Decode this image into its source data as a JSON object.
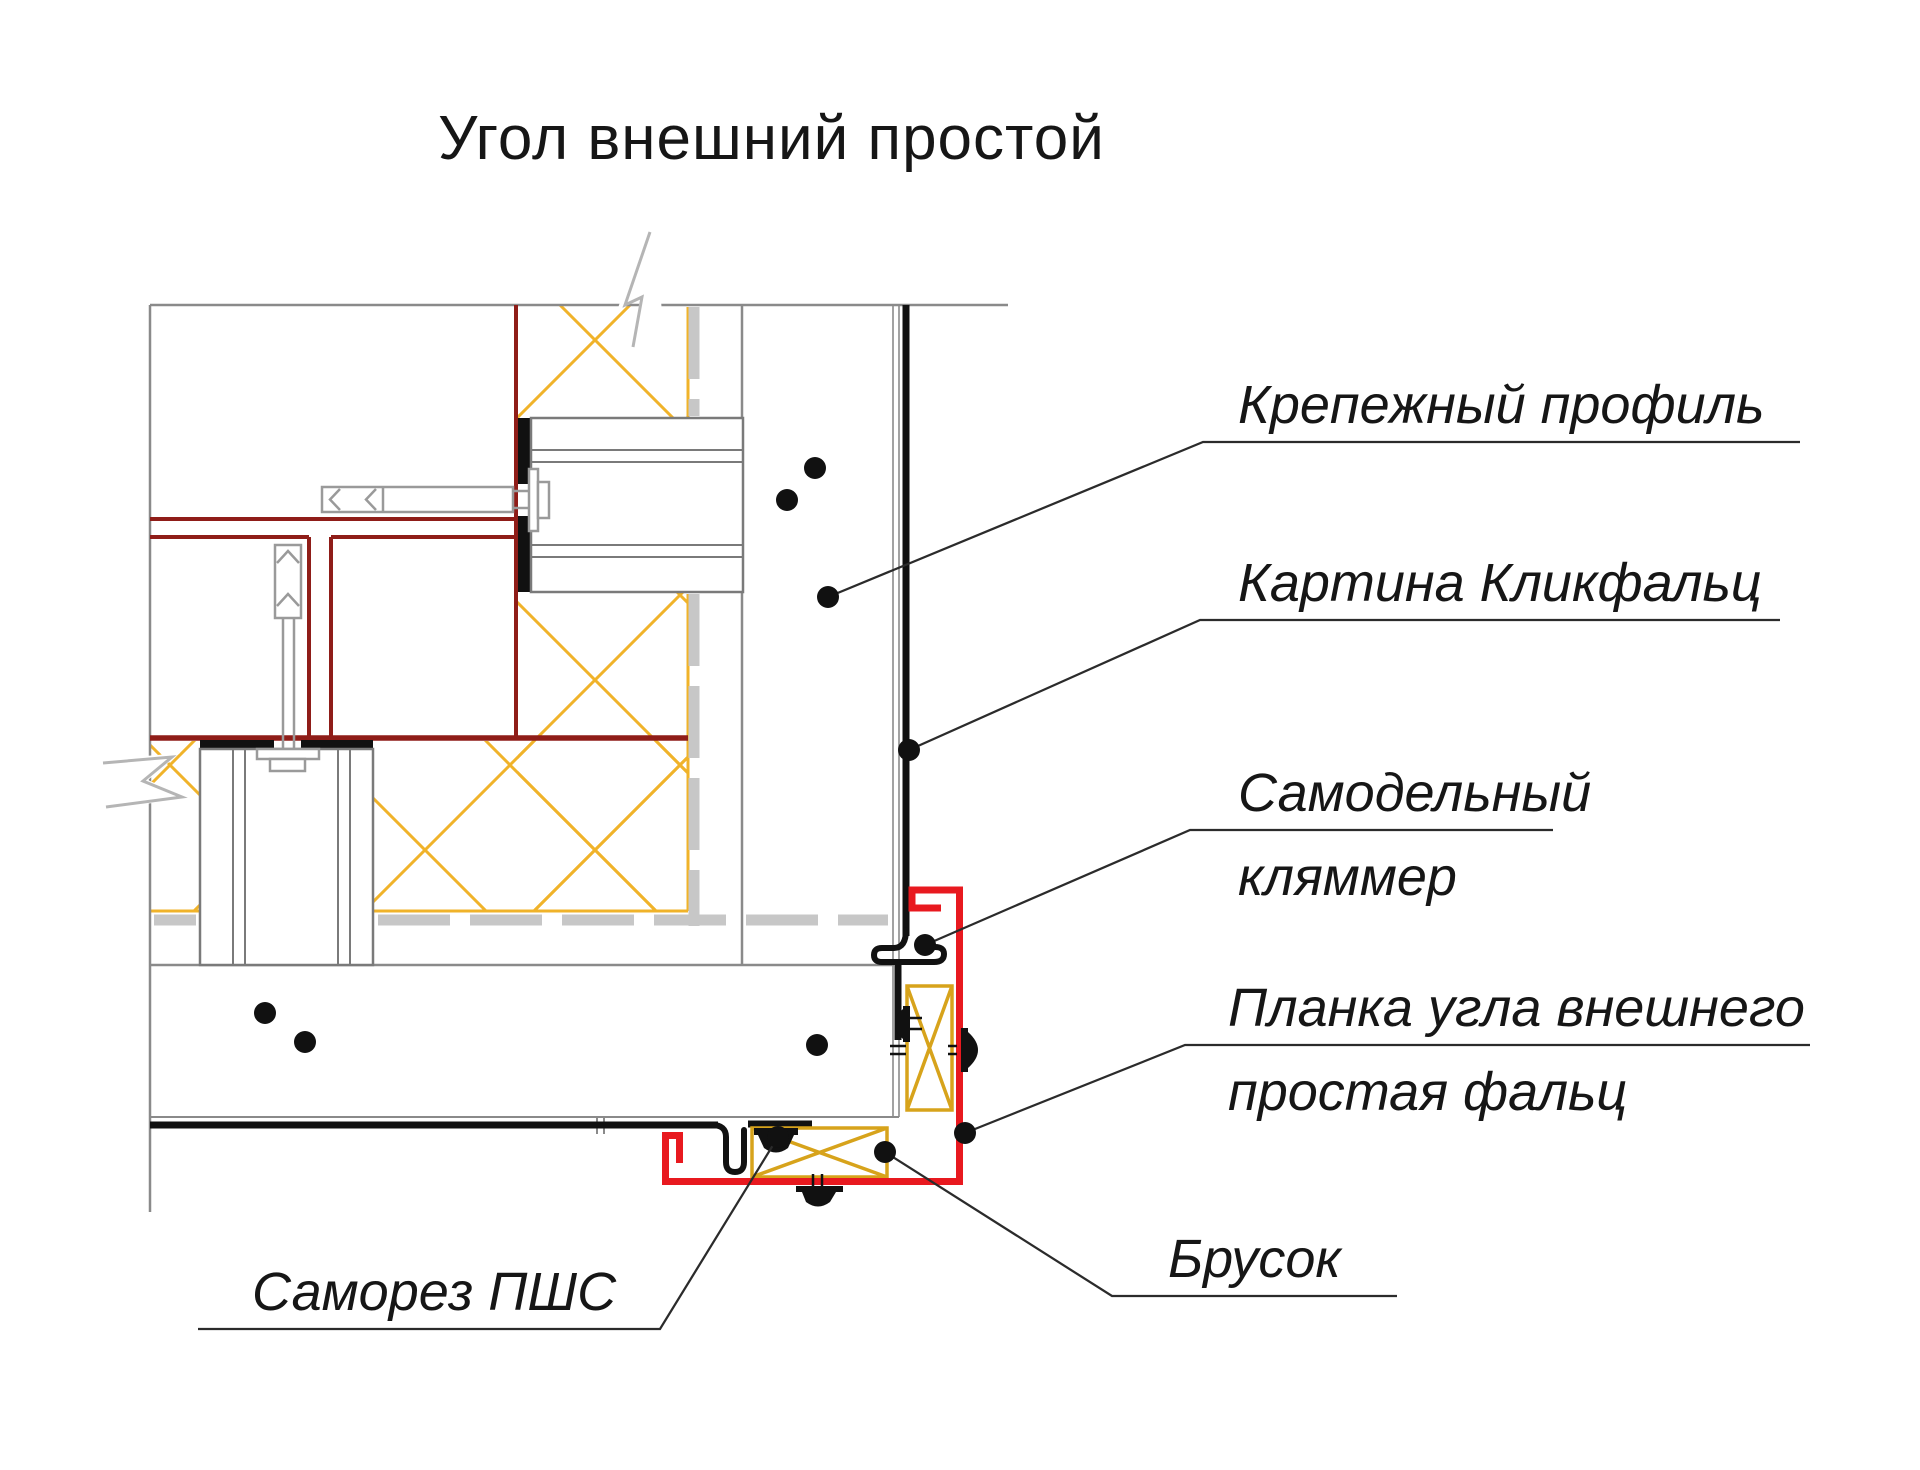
{
  "title": "Угол внешний простой",
  "diagram": {
    "type": "construction-detail",
    "view": "plan section of a simple external corner with click-seam facade",
    "labels": {
      "fastening_profile": "Крепежный профиль",
      "panel": "Картина Кликфальц",
      "clamp_line1": "Самодельный",
      "clamp_line2": "кляммер",
      "corner_strip_line1": "Планка угла внешнего",
      "corner_strip_line2": "простая фальц",
      "block": "Брусок",
      "screw": "Саморез ПШС"
    },
    "colors": {
      "corner_strip_red": "#e8191f",
      "vapor_barrier_dark_red": "#8f1d18",
      "insulation_yellow": "#f0b32a",
      "wood_block_yellow": "#d7a31b",
      "structure_gray": "#8a8a8a",
      "membrane_gray": "#c7c7c7",
      "panel_black": "#111111",
      "text_color": "#161616"
    }
  }
}
